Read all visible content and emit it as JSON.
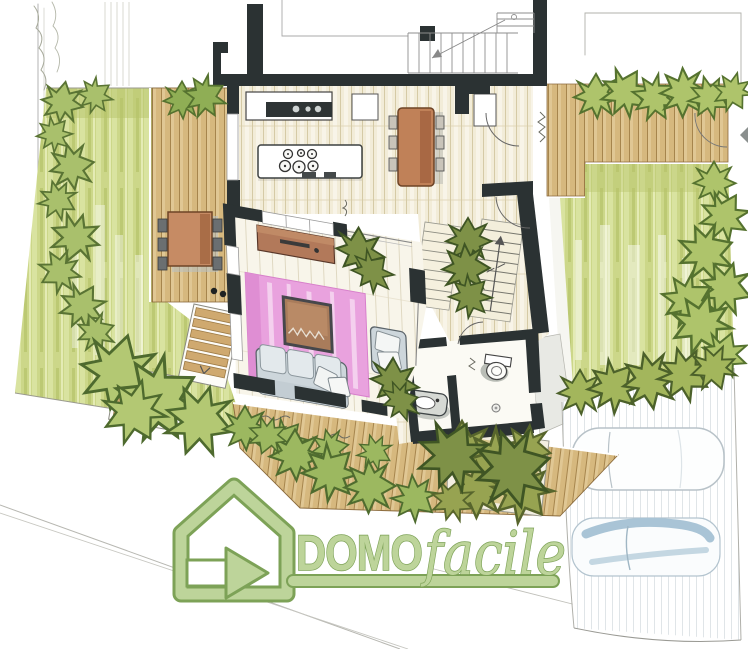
{
  "watermark": {
    "brand_primary": "DOMO",
    "brand_secondary": "facile",
    "logo_icon": "house-arrow-icon",
    "logo_fill": "#bdd49a",
    "logo_outline": "#7da257"
  },
  "palette": {
    "wall_dark": "#2b3233",
    "floor_cream": "#f2ecd8",
    "deck_tan": "#d6b87e",
    "lawn_green": "#ccd789",
    "hedge_green": "#a9c06c",
    "rug_pink": "#e9a2de",
    "wood_furniture": "#c08158",
    "sofa_gray": "#cdd6db",
    "car_blue": "#a9c4d6",
    "paper_white": "#ffffff"
  },
  "elements": [
    "left-garden-lawn",
    "right-garden-lawn",
    "wood-deck-left",
    "wood-deck-right",
    "wood-deck-bottom",
    "outdoor-dining-table",
    "kitchen-counter",
    "kitchen-island",
    "cooktop-burners",
    "dining-table",
    "living-room",
    "pink-rug",
    "sofa",
    "coffee-table",
    "armchair",
    "sideboard",
    "interior-staircase",
    "exterior-staircase",
    "bathroom",
    "toilet",
    "sink",
    "planting-bed",
    "hedges",
    "shrubs",
    "trees",
    "driveway",
    "car-top",
    "car-bottom",
    "street-boundary",
    "watermark-logo"
  ]
}
